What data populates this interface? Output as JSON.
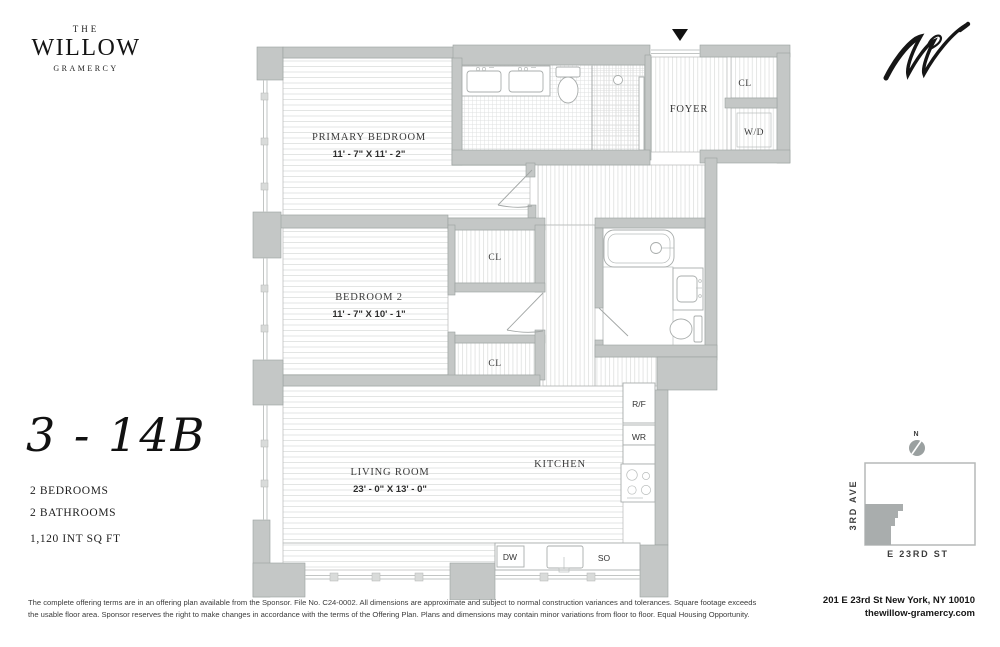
{
  "brand": {
    "pre": "THE",
    "name": "WILLOW",
    "sub": "GRAMERCY",
    "monogram_icon": "script-w-monogram"
  },
  "unit": {
    "number": "3 - 14B",
    "bedrooms": "2 BEDROOMS",
    "bathrooms": "2 BATHROOMS",
    "area": "1,120 INT SQ FT"
  },
  "plan": {
    "entry_icon": "entry-arrow-down",
    "rooms": {
      "primary_bedroom": {
        "name": "PRIMARY BEDROOM",
        "dims": "11' - 7\" X 11' - 2\""
      },
      "bedroom_2": {
        "name": "BEDROOM 2",
        "dims": "11' - 7\" X 10' - 1\""
      },
      "living_room": {
        "name": "LIVING ROOM",
        "dims": "23' - 0\" X 13' - 0\""
      },
      "kitchen": {
        "name": "KITCHEN"
      },
      "foyer": {
        "name": "FOYER"
      }
    },
    "labels": {
      "closet": "CL",
      "washer_dryer": "W/D",
      "refrigerator": "R/F",
      "wr": "WR",
      "dishwasher": "DW",
      "stove_oven": "SO"
    }
  },
  "map": {
    "compass": "N",
    "avenue": "3RD AVE",
    "street": "E 23RD ST"
  },
  "footer": {
    "disclaimer": "The complete offering terms are in an offering plan available from the Sponsor. File No. C24-0002.   All dimensions are approximate and subject to normal construction variances and tolerances. Square footage exceeds the usable floor area. Sponsor reserves the right to make changes in accordance with the terms of the Offering Plan. Plans and dimensions may contain minor variations from floor to floor.  Equal Housing Opportunity.",
    "address": "201 E 23rd St New York, NY 10010",
    "website": "thewillow-gramercy.com"
  }
}
